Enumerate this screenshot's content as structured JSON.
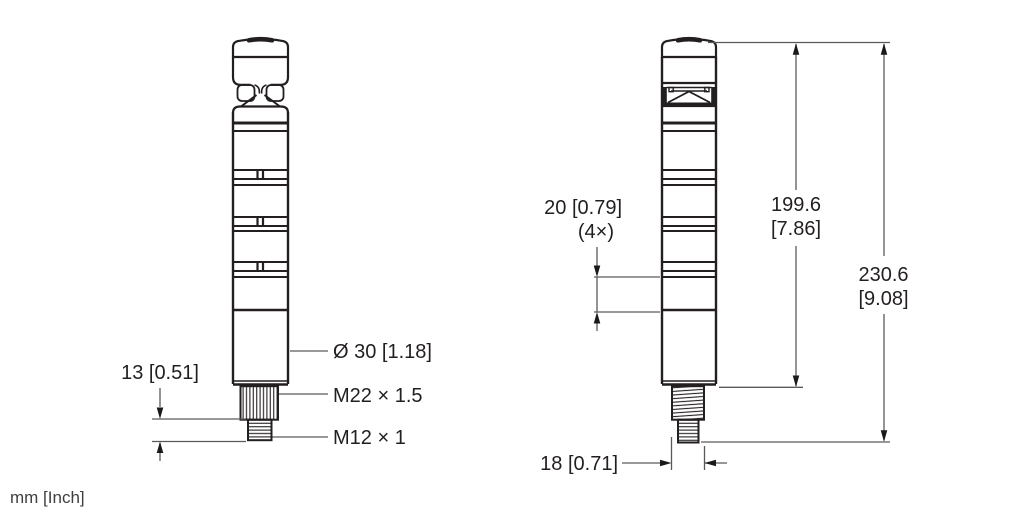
{
  "units_note": "mm [Inch]",
  "left_view": {
    "diameter_label": "Ø 30 [1.18]",
    "thread_large_label": "M22 × 1.5",
    "thread_small_label": "M12 × 1",
    "stud_length": "13 [0.51]"
  },
  "right_view": {
    "segment_height": "20 [0.79]",
    "segment_count": "(4×)",
    "body_height_mm": "199.6",
    "body_height_inch": "[7.86]",
    "total_height_mm": "230.6",
    "total_height_inch": "[9.08]",
    "thread_width": "18 [0.71]"
  },
  "colors": {
    "object_line": "#231f20",
    "dimension_line": "#5a5a5a",
    "arrow": "#1a1a1a",
    "background": "#ffffff"
  }
}
